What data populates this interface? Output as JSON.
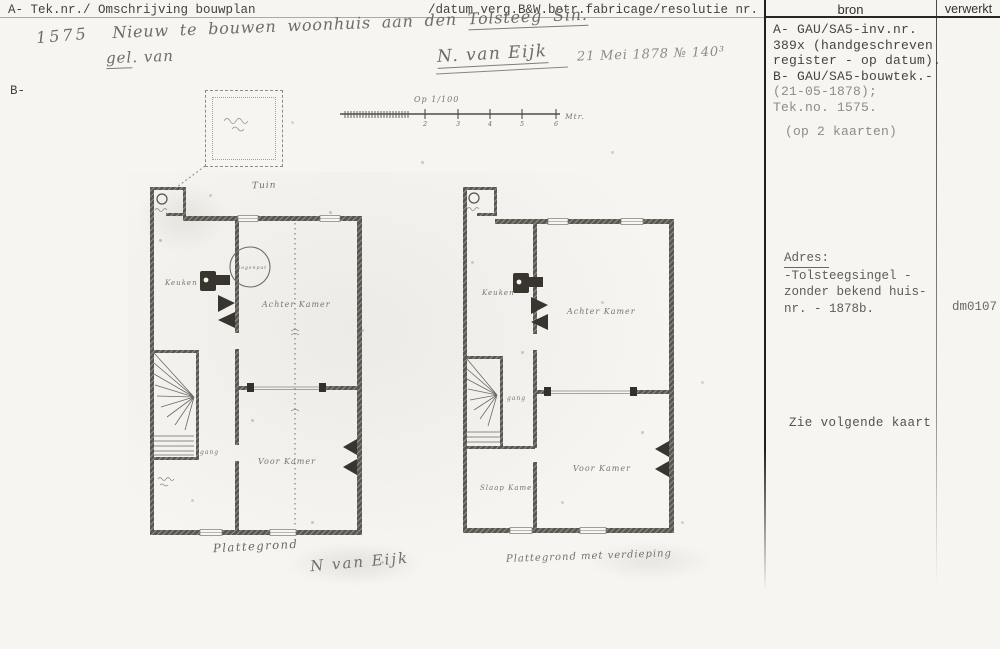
{
  "header": {
    "left": "A- Tek.nr./ Omschrijving bouwplan",
    "middle": "/datum verg.B&W.betr.fabricage/resolutie nr.",
    "bron_label": "bron",
    "verwerkt_label": "verwerkt"
  },
  "margin_label": "B-",
  "handwriting": {
    "tek_nr": "1575",
    "title_main": "Nieuw te bouwen woonhuis aan den ",
    "title_street": "Tolsteeg Sin.",
    "wrap_underlined": "gel",
    "wrap_rest": ". van",
    "architect": "N. van Eijk",
    "date_resolution": "21 Mei 1878 № 140³"
  },
  "bron_panel": {
    "lines": [
      "A- GAU/SA5-inv.nr.",
      "389x (handgeschreven",
      "register - op datum).",
      "B- GAU/SA5-bouwtek.-",
      "(21-05-1878);",
      "Tek.no. 1575.",
      "(op 2 kaarten)"
    ]
  },
  "adres_panel": {
    "heading": "Adres:",
    "lines": [
      "-Tolsteegsingel -",
      "zonder bekend huis-",
      "nr. - 1878b."
    ],
    "code": "dm0107"
  },
  "note": "Zie volgende kaart",
  "scale_bar": {
    "title": "Op 1/100",
    "ticks": [
      "2",
      "3",
      "4",
      "5",
      "6"
    ],
    "unit": "Mtr."
  },
  "plans": {
    "garden_label": "Tuin",
    "left": {
      "kitchen": "Keuken",
      "back_room": "Achter Kamer",
      "front_room": "Voor Kamer",
      "hall": "gang",
      "well": "Regenput",
      "caption": "Plattegrond",
      "signature": "N van Eijk"
    },
    "right": {
      "kitchen": "Keuken",
      "back_room": "Achter Kamer",
      "front_room": "Voor Kamer",
      "hall": "gang",
      "bedroom": "Slaap Kamer",
      "caption": "Plattegrond met verdieping"
    }
  }
}
